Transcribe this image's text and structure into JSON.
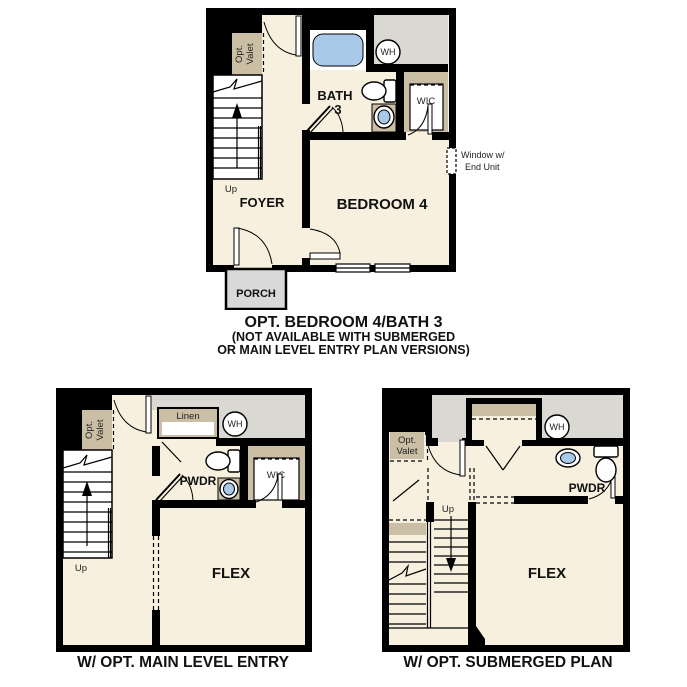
{
  "colors": {
    "wall": "#000000",
    "floor": "#f7f0df",
    "exterior": "#d9d8d3",
    "accent_tan": "#cabfa4",
    "fixture_blue": "#a9c9e8",
    "porch": "#d9d9d9"
  },
  "plans": {
    "bedroom4": {
      "caption_line1": "OPT. BEDROOM 4/BATH 3",
      "caption_line2": "(NOT AVAILABLE WITH SUBMERGED",
      "caption_line3": "OR MAIN LEVEL ENTRY PLAN VERSIONS)",
      "labels": {
        "opt_valet_line1": "Opt.",
        "opt_valet_line2": "Valet",
        "up": "Up",
        "foyer": "FOYER",
        "bath_line1": "BATH",
        "bath_line2": "3",
        "wh": "WH",
        "wic": "WIC",
        "bedroom": "BEDROOM 4",
        "window_note_line1": "Window w/",
        "window_note_line2": "End Unit",
        "porch": "PORCH"
      }
    },
    "main_level_entry": {
      "caption": "W/ OPT. MAIN LEVEL ENTRY",
      "labels": {
        "opt_valet_line1": "Opt.",
        "opt_valet_line2": "Valet",
        "linen": "Linen",
        "wh": "WH",
        "pwdr": "PWDR",
        "wic": "WIC",
        "up": "Up",
        "flex": "FLEX"
      }
    },
    "submerged": {
      "caption": "W/ OPT. SUBMERGED PLAN",
      "labels": {
        "opt_valet_line1": "Opt.",
        "opt_valet_line2": "Valet",
        "wh": "WH",
        "pwdr": "PWDR",
        "up": "Up",
        "flex": "FLEX"
      }
    }
  }
}
